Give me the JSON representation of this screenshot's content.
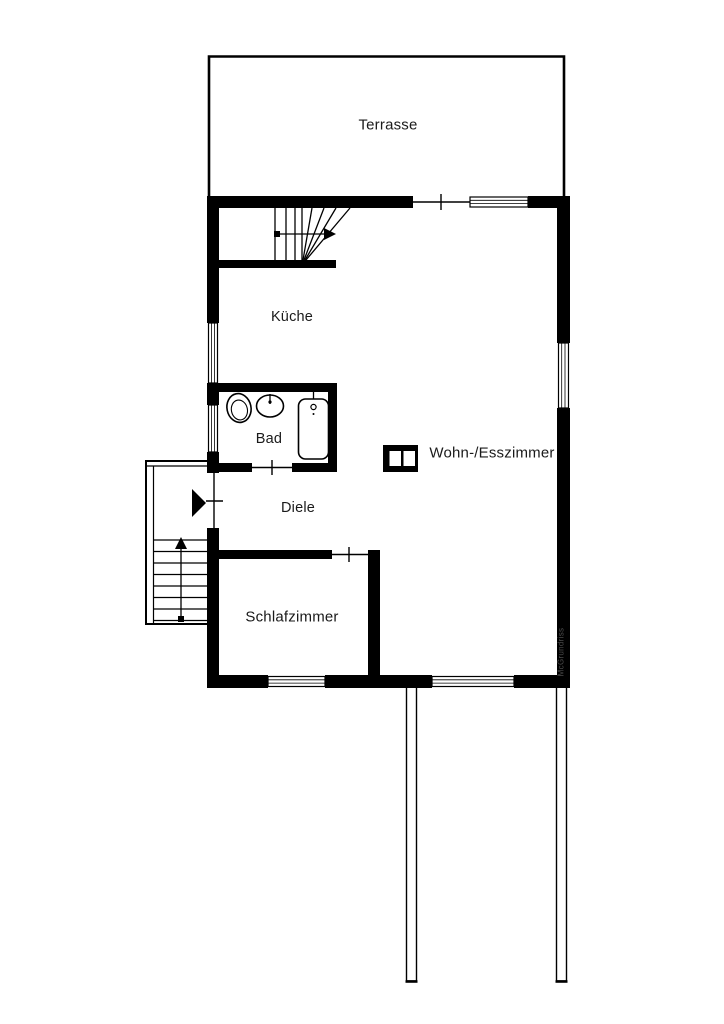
{
  "floorplan": {
    "title": "floor-plan",
    "labels": {
      "terrace": "Terrasse",
      "kitchen": "Küche",
      "bath": "Bad",
      "hall": "Diele",
      "living": "Wohn-/Esszimmer",
      "bedroom": "Schlafzimmer"
    },
    "watermark": "McGrundriss",
    "colors": {
      "wall": "#000000",
      "background": "#ffffff",
      "text": "#1a1a1a",
      "watermark": "#4a4a4a"
    },
    "icons": {
      "fireplace": "fireplace-icon",
      "toilet": "toilet-icon",
      "sink": "sink-icon",
      "bathtub": "bathtub-icon",
      "entrance_arrow": "entrance-arrow-icon",
      "stair_up_arrow": "stair-direction-arrow"
    }
  }
}
